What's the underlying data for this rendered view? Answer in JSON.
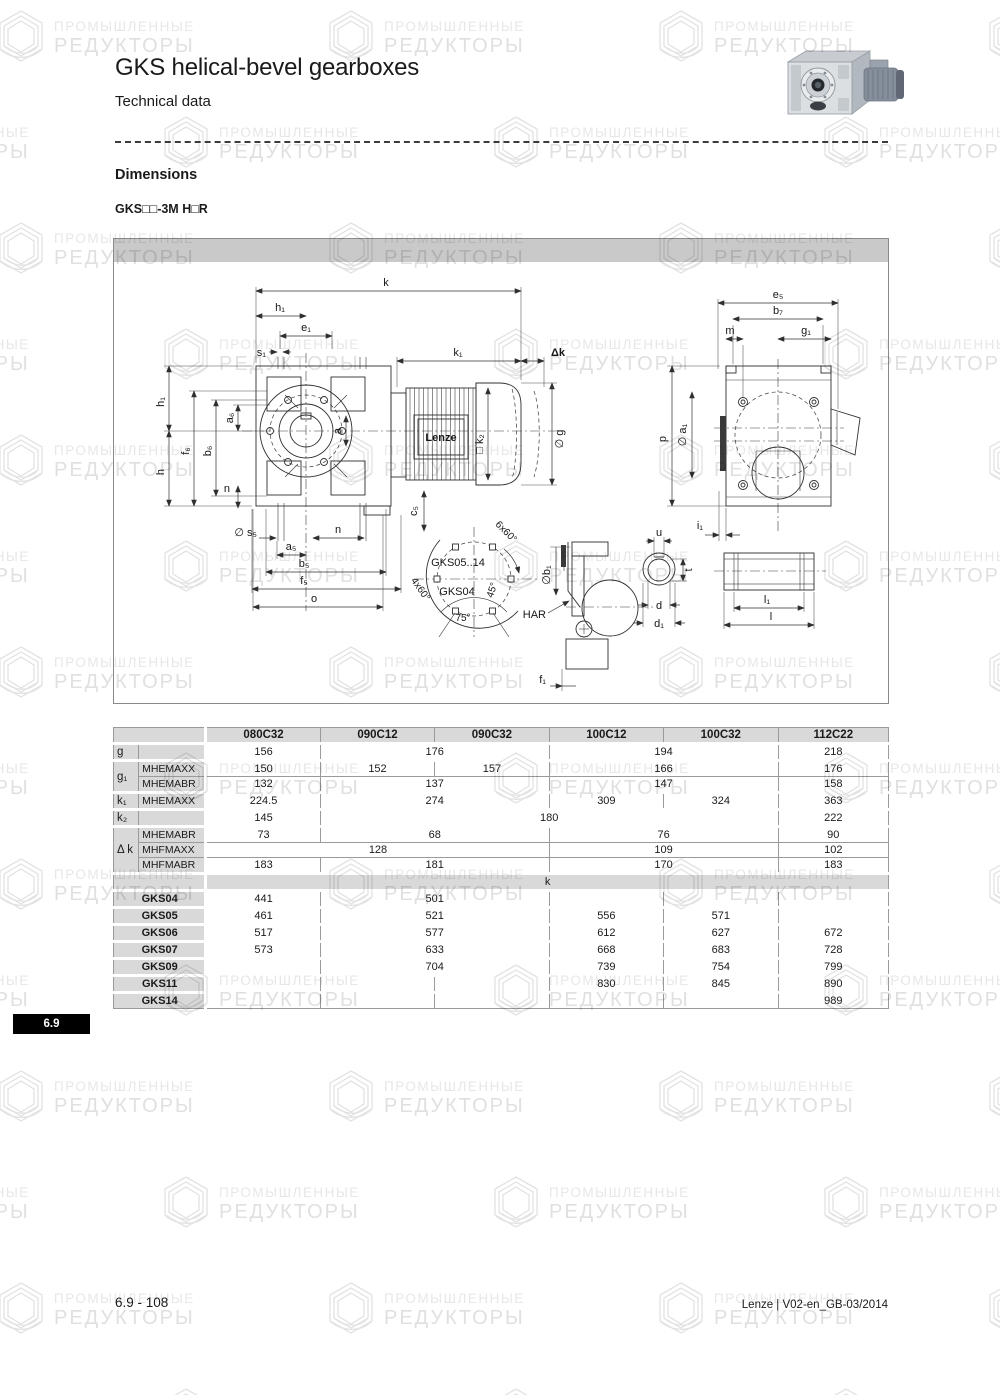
{
  "page": {
    "title": "GKS helical-bevel gearboxes",
    "subtitle": "Technical data",
    "section_heading": "Dimensions",
    "model_line": "GKS□□-3M H□R",
    "section_tab": "6.9",
    "footer_left": "6.9 - 108",
    "footer_right": "Lenze | V02-en_GB-03/2014"
  },
  "watermark": {
    "line1": "ПРОМЫШЛЕННЫЕ",
    "line2": "РЕДУКТОРЫ"
  },
  "drawing": {
    "labels": {
      "k": "k",
      "h1_top": "h₁",
      "e1": "e₁",
      "s1": "s₁",
      "k1": "k₁",
      "dk": "Δk",
      "h1_left": "h₁",
      "h": "h",
      "f6": "f₆",
      "b6": "b₆",
      "a6": "a₆",
      "n_left": "n",
      "a": "a",
      "c5": "c₅",
      "k2": "□ k₂",
      "g": "∅ g",
      "lenze": "Lenze",
      "s5": "∅ s₅",
      "n_bottom": "n",
      "a5": "a₅",
      "b5": "b₅",
      "f5": "f₅",
      "o": "o",
      "e5": "e₅",
      "b7": "b₇",
      "m": "m",
      "g1": "g₁",
      "p": "p",
      "a1": "∅ a₁",
      "i1": "i₁",
      "bc_count": "6x60°",
      "bc_models_upper": "GKS05..14",
      "bc_models_lower": "GKS04",
      "bc_count2": "4x60°",
      "bc_angle45": "45°",
      "bc_angle75": "75°",
      "b1": "∅b₁",
      "har": "HAR",
      "f1": "f₁",
      "u": "u",
      "t": "t",
      "d": "d",
      "d1": "d₁",
      "l1": "l₁",
      "l": "l"
    }
  },
  "table": {
    "columns": [
      "080C32",
      "090C12",
      "090C32",
      "100C12",
      "100C32",
      "112C22"
    ],
    "body": [
      {
        "gap": true,
        "label": "g",
        "rowspan": 1,
        "sub": "",
        "cells": [
          [
            "156",
            1
          ],
          [
            "176",
            2
          ],
          [
            "194",
            2
          ],
          [
            "218",
            1
          ]
        ]
      },
      {
        "gap": true,
        "label": "g₁",
        "rowspan": 2,
        "sub": "MHEMAXX",
        "cells": [
          [
            "150",
            1
          ],
          [
            "152",
            1
          ],
          [
            "157",
            1
          ],
          [
            "166",
            2
          ],
          [
            "176",
            1
          ]
        ]
      },
      {
        "sub": "MHEMABR",
        "cells": [
          [
            "132",
            1
          ],
          [
            "137",
            2
          ],
          [
            "147",
            2
          ],
          [
            "158",
            1
          ]
        ]
      },
      {
        "gap": true,
        "label": "k₁",
        "rowspan": 1,
        "sub": "MHEMAXX",
        "cells": [
          [
            "224.5",
            1
          ],
          [
            "274",
            2
          ],
          [
            "309",
            1
          ],
          [
            "324",
            1
          ],
          [
            "363",
            1
          ]
        ]
      },
      {
        "gap": true,
        "label": "k₂",
        "rowspan": 1,
        "sub": "",
        "cells": [
          [
            "145",
            1
          ],
          [
            "180",
            4
          ],
          [
            "222",
            1
          ]
        ]
      },
      {
        "gap": true,
        "label": "Δ k",
        "rowspan": 3,
        "sub": "MHEMABR",
        "cells": [
          [
            "73",
            1
          ],
          [
            "68",
            2
          ],
          [
            "76",
            2
          ],
          [
            "90",
            1
          ]
        ]
      },
      {
        "sub": "MHFMAXX",
        "cells": [
          [
            "128",
            3
          ],
          [
            "109",
            2
          ],
          [
            "102",
            1
          ]
        ]
      },
      {
        "sub": "MHFMABR",
        "cells": [
          [
            "183",
            1
          ],
          [
            "181",
            2
          ],
          [
            "170",
            2
          ],
          [
            "183",
            1
          ]
        ]
      },
      {
        "gap": true,
        "type": "k",
        "text": "k"
      },
      {
        "gap": true,
        "type": "gks",
        "label": "GKS04",
        "cells": [
          [
            "441",
            1
          ],
          [
            "501",
            2
          ],
          [
            "",
            1
          ],
          [
            "",
            1
          ],
          [
            "",
            1
          ]
        ]
      },
      {
        "gap": true,
        "type": "gks",
        "label": "GKS05",
        "cells": [
          [
            "461",
            1
          ],
          [
            "521",
            2
          ],
          [
            "556",
            1
          ],
          [
            "571",
            1
          ],
          [
            "",
            1
          ]
        ]
      },
      {
        "gap": true,
        "type": "gks",
        "label": "GKS06",
        "cells": [
          [
            "517",
            1
          ],
          [
            "577",
            2
          ],
          [
            "612",
            1
          ],
          [
            "627",
            1
          ],
          [
            "672",
            1
          ]
        ]
      },
      {
        "gap": true,
        "type": "gks",
        "label": "GKS07",
        "cells": [
          [
            "573",
            1
          ],
          [
            "633",
            2
          ],
          [
            "668",
            1
          ],
          [
            "683",
            1
          ],
          [
            "728",
            1
          ]
        ]
      },
      {
        "gap": true,
        "type": "gks",
        "label": "GKS09",
        "cells": [
          [
            "",
            1
          ],
          [
            "704",
            2
          ],
          [
            "739",
            1
          ],
          [
            "754",
            1
          ],
          [
            "799",
            1
          ]
        ]
      },
      {
        "gap": true,
        "type": "gks",
        "label": "GKS11",
        "cells": [
          [
            "",
            1
          ],
          [
            "",
            1
          ],
          [
            "",
            1
          ],
          [
            "830",
            1
          ],
          [
            "845",
            1
          ],
          [
            "890",
            1
          ]
        ]
      },
      {
        "gap": true,
        "type": "gks",
        "label": "GKS14",
        "cells": [
          [
            "",
            1
          ],
          [
            "",
            1
          ],
          [
            "",
            1
          ],
          [
            "",
            1
          ],
          [
            "",
            1
          ],
          [
            "989",
            1
          ]
        ]
      }
    ]
  }
}
